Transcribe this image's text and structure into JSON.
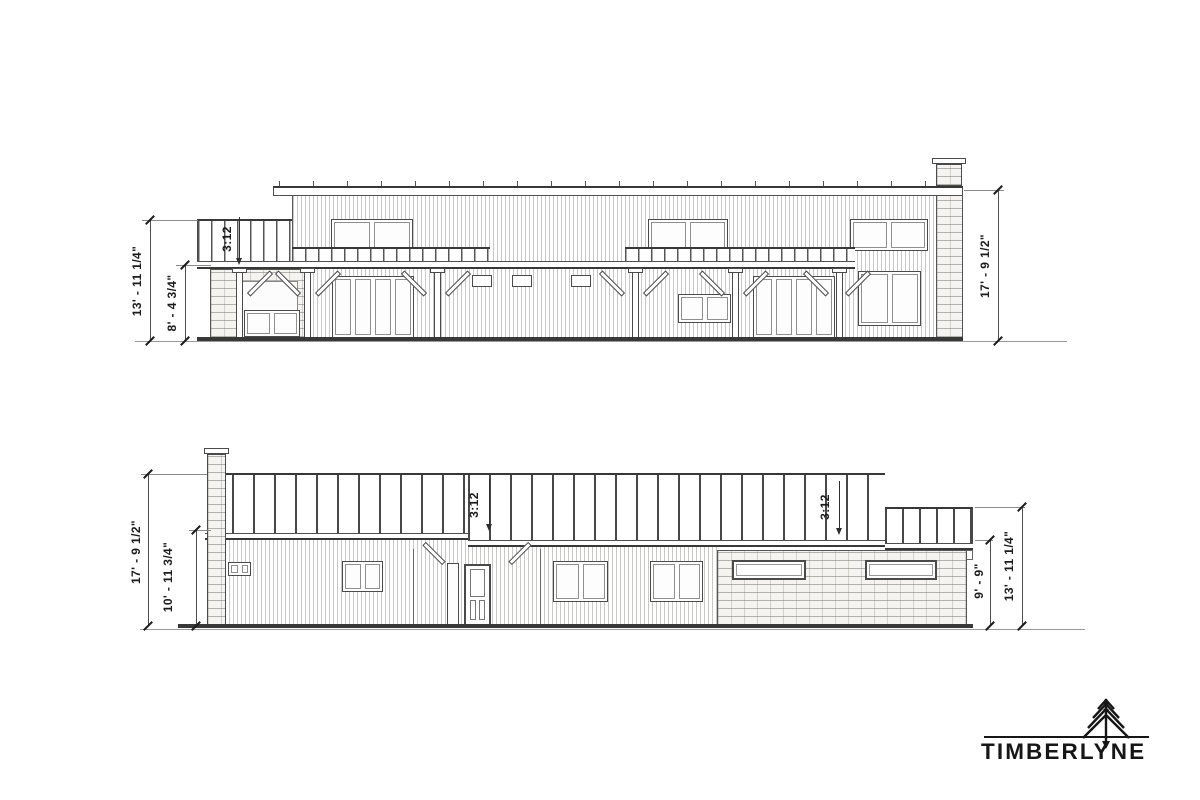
{
  "sheet": {
    "background": "#ffffff"
  },
  "upper_elevation": {
    "slope_label": "3:12",
    "dim_left_outer": "13' - 11 1/4\"",
    "dim_left_inner": "8' - 4 3/4\"",
    "dim_right": "17' - 9 1/2\""
  },
  "lower_elevation": {
    "slope_label_main": "3:12",
    "slope_label_low": "3:12",
    "dim_left_outer": "17' - 9 1/2\"",
    "dim_left_inner": "10' - 11 3/4\"",
    "dim_right_inner": "9' - 9\"",
    "dim_right_outer": "13' - 11 1/4\""
  },
  "logo": {
    "brand": "TIMBERLYNE",
    "tree_icon": "pine-tree-icon",
    "color": "#161616"
  },
  "colors": {
    "line": "#4a4a4a",
    "line_dark": "#383838",
    "dim_text": "#1c1c1c",
    "stone_fill": "#f5f4f1",
    "ground": "#9a9a9a"
  }
}
